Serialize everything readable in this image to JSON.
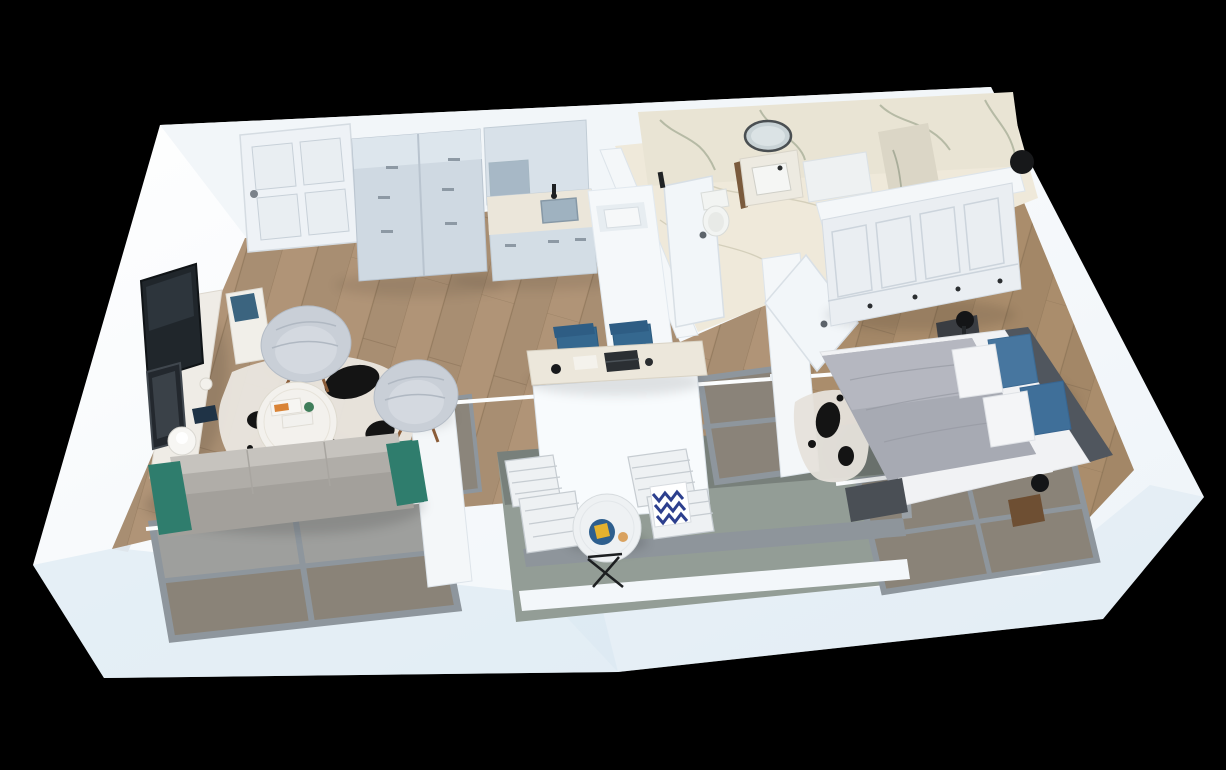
{
  "scene": {
    "type": "3d-floorplan-render",
    "description": "Isometric 3D render of a one-bedroom apartment floor plan on a black background",
    "background": "#000000"
  },
  "palette": {
    "background": "#000000",
    "wallWhite": "#f6f9fb",
    "wallShade": "#dfe6ec",
    "wallCool": "#d9e7f2",
    "topBand": "#f2f6f9",
    "woodFloor": "#b09477",
    "bedroomFloor": "#aa8d6c",
    "windowWood": "#7b6b57",
    "marbleWall": "#e9e4d4",
    "marbleFloor": "#efe9da",
    "showerWall": "#dbd6c6",
    "marbleVein": "#aab09a",
    "balconyFloor": "#939d96",
    "railGray": "#8e959b",
    "sillWhite": "#f3f7fa",
    "frameGray": "#8e969d",
    "glassBlue": "#aab6bf",
    "railWhite": "#fbfdfe",
    "doorWhite": "#eef2f6",
    "leafWhite": "#f2f6f9",
    "interiorWall": "#f4f7f9",
    "partitionWhite": "#f8fbfd",
    "cabinetBlue": "#cfd9e2",
    "cabinetTop": "#dde6ed",
    "upperCabinet": "#d8e1e9",
    "counterMarble": "#ebe6da",
    "sinkBlue": "#9fb2c0",
    "peninsulaWhite": "#f5f8fa",
    "vanityTop": "#edeae1",
    "vanityWood": "#7a5a3c",
    "fixtureWhite": "#f2f4f2",
    "binBlack": "#17181a",
    "sofaTeal": "#2f7d6d",
    "sofaSeatLight": "#c6c3be",
    "sofaSeatMid": "#b0ada8",
    "sofaBack": "#a3a09b",
    "armchairGray": "#c9cfd7",
    "armchairInner": "#d4d9e0",
    "tableWhite": "#f3f1ed",
    "rugWhite": "#e9e5df",
    "rugBlack": "#141414",
    "tvBlack": "#20262b",
    "artDark": "#23282e",
    "consoleWhite": "#efece6",
    "benchWhite": "#f1efe9",
    "benchBlue": "#3b647f",
    "bookNavy": "#1f3346",
    "deskChairBlue": "#35688f",
    "deskMarble": "#ece7db",
    "laptopDark": "#2b2f33",
    "paperWhite": "#f4f2ec",
    "wardrobeWhite": "#eaeef2",
    "nightstandDark": "#3a3d42",
    "lampBlack": "#141517",
    "blanketGray": "#a7aab3",
    "blanketLight": "#b7bac2",
    "sheetWhite": "#f1f2f4",
    "pillowWhite": "#f4f5f7",
    "pillowBlue": "#47769f",
    "pillowBlue2": "#3f6f99",
    "bedFrameDark": "#50565e",
    "footboardDark": "#4a4f55",
    "sideTableWood": "#6e4f33",
    "bedroomRug": "#e6e2db",
    "balconyChairWhite": "#eef1f3",
    "chevronBlue": "#2c3f8e",
    "trayBlue": "#2e5f8e",
    "lemonYellow": "#e5b22e",
    "cupTan": "#d9a25f",
    "stoolBlack": "#1d1f21"
  },
  "rooms": [
    {
      "id": "living-room",
      "objects": [
        "sofa with teal frame and gray cushions",
        "two tufted armchairs",
        "round coffee table with magazines",
        "black and white cowhide rug",
        "wall mounted TV",
        "marble media console",
        "bench with blue cushion",
        "sphere table lamp",
        "large corner window"
      ]
    },
    {
      "id": "kitchen",
      "objects": [
        "tall storage cabinet",
        "upper cabinets with glass door",
        "base cabinets with marble counter and sink",
        "white peninsula unit"
      ]
    },
    {
      "id": "hallway",
      "objects": [
        "white paneled entrance door",
        "desk with laptop and papers",
        "two blue chairs"
      ]
    },
    {
      "id": "bathroom",
      "objects": [
        "marble feature walls",
        "round mirror",
        "wood vanity with white basin",
        "wall hung toilet",
        "marble shower partition",
        "black bin",
        "door ajar"
      ]
    },
    {
      "id": "bedroom",
      "objects": [
        "double bed with gray blanket",
        "white and blue pillows",
        "white paneled wardrobe",
        "black nightstand with lamp",
        "spotted rug",
        "window with balustrade",
        "open white door"
      ]
    },
    {
      "id": "balcony",
      "objects": [
        "two white slat chairs",
        "blue chevron pillow",
        "round bistro table with blue tray",
        "folding stool",
        "glass balustrade",
        "gray railing"
      ]
    }
  ]
}
